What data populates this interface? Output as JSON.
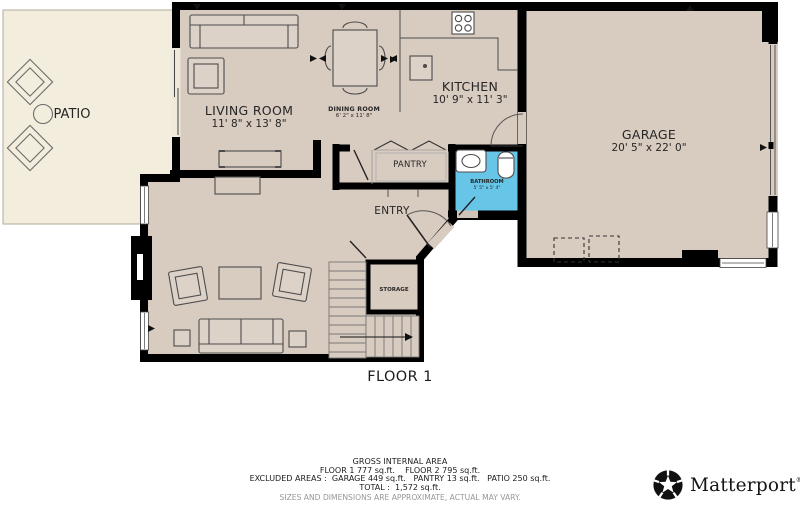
{
  "plan": {
    "floor_label": "FLOOR 1",
    "rooms": {
      "patio": {
        "name": "PATIO"
      },
      "living_room": {
        "name": "LIVING ROOM",
        "dims": "11' 8\" x 13' 8\""
      },
      "dining_room": {
        "name": "DINING ROOM",
        "dims": "6' 2\" x 11' 8\""
      },
      "kitchen": {
        "name": "KITCHEN",
        "dims": "10' 9\" x 11' 3\""
      },
      "garage": {
        "name": "GARAGE",
        "dims": "20' 5\" x 22' 0\""
      },
      "pantry": {
        "name": "PANTRY"
      },
      "bathroom": {
        "name": "BATHROOM",
        "dims": "5' 5\" x 5' 4\""
      },
      "entry": {
        "name": "ENTRY"
      },
      "storage": {
        "name": "STORAGE"
      }
    },
    "colors": {
      "wall": "#000000",
      "floor": "#d8cbc0",
      "patio": "#f2eddc",
      "bathroom": "#67c5e8"
    }
  },
  "footer": {
    "title": "GROSS INTERNAL AREA",
    "floors": "FLOOR 1 777 sq.ft.    FLOOR 2 795 sq.ft.",
    "excluded": "EXCLUDED AREAS :  GARAGE 449 sq.ft.   PANTRY 13 sq.ft.   PATIO 250 sq.ft.",
    "total": "TOTAL :  1,572 sq.ft.",
    "disclaimer": "SIZES AND DIMENSIONS ARE APPROXIMATE, ACTUAL MAY VARY."
  },
  "brand": {
    "name": "Matterport",
    "registered": "®"
  }
}
